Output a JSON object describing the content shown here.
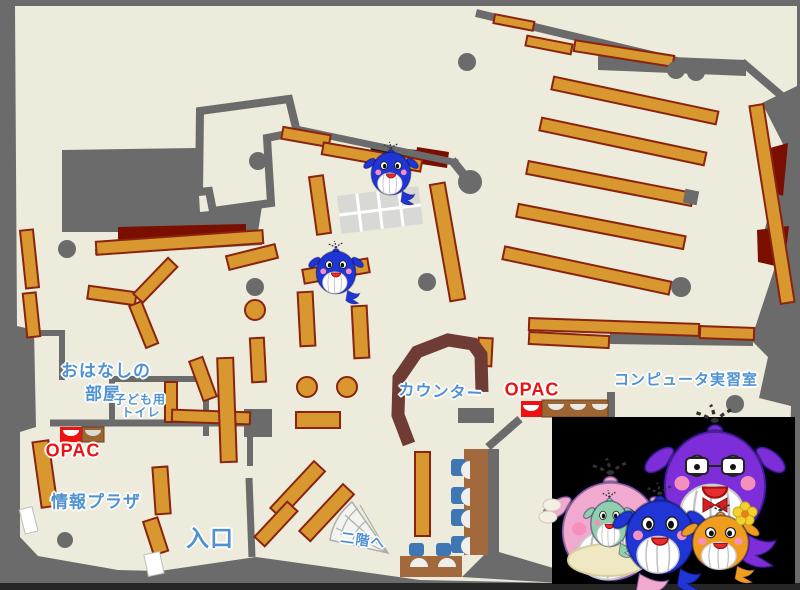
{
  "labels": {
    "storytelling_room_line1": "おはなしの",
    "storytelling_room_line2": "部屋",
    "kids_toilet_line1": "子ども用",
    "kids_toilet_line2": "トイレ",
    "info_plaza": "情報プラザ",
    "entrance": "入口",
    "counter": "カウンター",
    "opac_left": "OPAC",
    "opac_right": "OPAC",
    "computer_room": "コンピュータ実習室",
    "to_second_floor": "二階へ"
  },
  "icons": {
    "stairs": "fan-staircase",
    "mascots": [
      "blue-whale-mascot",
      "blue-whale-mascot-2",
      "pink-whale-mother",
      "purple-whale-father",
      "blue-whale-child",
      "orange-whale-child",
      "teal-baby-whale"
    ]
  },
  "colors": {
    "background": "#6B6B6B",
    "floor": "#EDEBDB",
    "shelf": "#D8982F",
    "shelf_border": "#8A2410",
    "dark_red": "#7A0E00",
    "counter": "#6F3C35",
    "label_blue": "#4F92D2",
    "opac_red": "#EE1111",
    "desk_brown": "#A2693C",
    "chair_blue": "#3F77B4",
    "photo_box": "#000000"
  }
}
